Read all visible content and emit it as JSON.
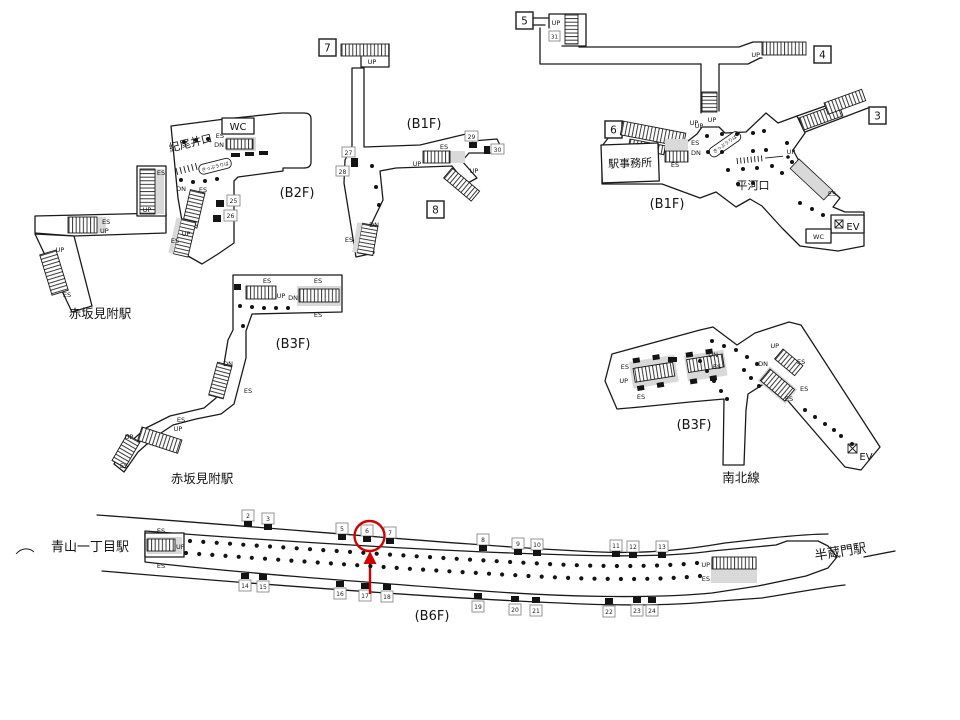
{
  "labels": {
    "es": "ES",
    "up": "UP",
    "dn": "DN",
    "wc": "WC",
    "ev": "EV"
  },
  "floors": {
    "b1f": "(B1F)",
    "b2f": "(B2F)",
    "b3f": "(B3F)",
    "b6f": "(B6F)"
  },
  "stations": {
    "akasaka_mitsuke": "赤坂見附駅",
    "aoyama_itchome": "青山一丁目駅",
    "hanzomon": "半蔵門駅"
  },
  "lines": {
    "namboku": "南北線"
  },
  "places": {
    "kioi_gate": "紀尾井口",
    "hirakawa_gate": "平河口",
    "station_office": "駅事務所",
    "ticket_office": "きっぷうりば"
  },
  "exits": {
    "e3": "3",
    "e4": "4",
    "e5": "5",
    "e6": "6",
    "e7": "7",
    "e8": "8"
  },
  "markers": {
    "m25": "25",
    "m26": "26",
    "m27": "27",
    "m28": "28",
    "m29": "29",
    "m30": "30",
    "m31": "31"
  },
  "platform": {
    "top_row": [
      "2",
      "3",
      "5",
      "6",
      "7",
      "8",
      "9",
      "10",
      "11",
      "12",
      "13"
    ],
    "bottom_row": [
      "14",
      "15",
      "16",
      "17",
      "18",
      "19",
      "20",
      "21",
      "22",
      "23",
      "24"
    ]
  }
}
